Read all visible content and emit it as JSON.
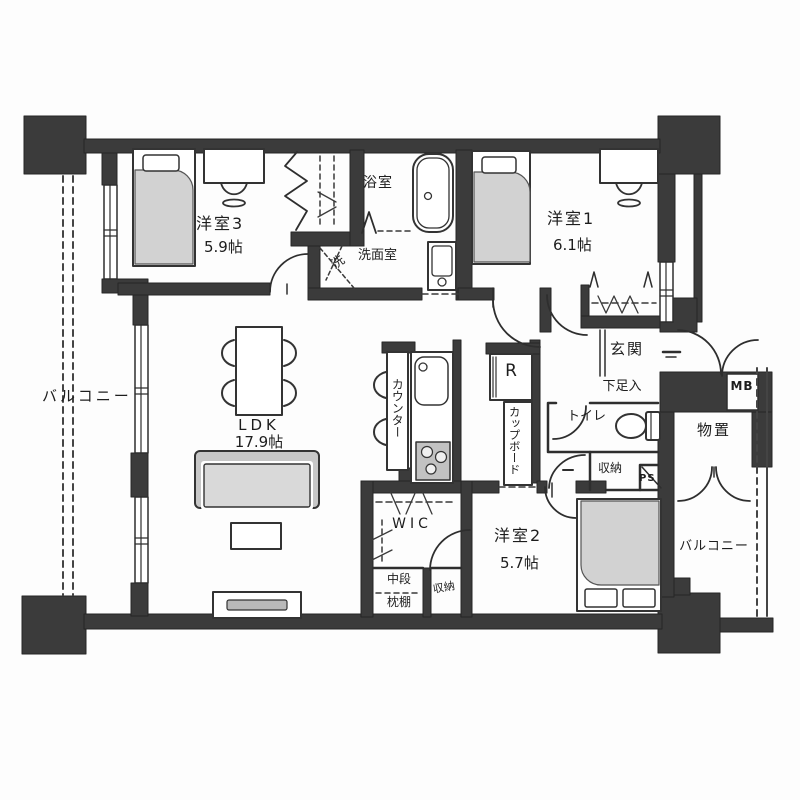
{
  "plan": {
    "type": "apartment-floorplan",
    "rooms": {
      "balcony_left": {
        "label": "バルコニー"
      },
      "bedroom3": {
        "label": "洋室3",
        "size": "5.9帖"
      },
      "bathroom": {
        "label": "浴室"
      },
      "washroom": {
        "label": "洗面室"
      },
      "washer_space": {
        "label": "洗"
      },
      "bedroom1": {
        "label": "洋室1",
        "size": "6.1帖"
      },
      "entrance": {
        "label": "玄関"
      },
      "shoe_cabinet": {
        "label": "下足入"
      },
      "meter_box": {
        "label": "MB"
      },
      "toilet": {
        "label": "トイレ"
      },
      "hall_storage": {
        "label": "収納"
      },
      "pipe_space": {
        "label": "PS"
      },
      "storage_room": {
        "label": "物置"
      },
      "balcony_right": {
        "label": "バルコニー"
      },
      "ldk": {
        "label": "LDK",
        "size": "17.9帖"
      },
      "counter": {
        "label": "カウンター"
      },
      "refrigerator": {
        "label": "R"
      },
      "cupboard": {
        "label": "カップボード"
      },
      "wic": {
        "label": "WIC"
      },
      "shelf_mid": {
        "label": "中段"
      },
      "shelf_pillow": {
        "label": "枕棚"
      },
      "wic_storage": {
        "label": "収納"
      },
      "bedroom2": {
        "label": "洋室2",
        "size": "5.7帖"
      }
    },
    "colors": {
      "wall": "#3b3b3b",
      "line": "#2e2e2e",
      "furniture": "#d2d2d2",
      "stove": "#c2c2c2",
      "background": "#fdfdfd"
    }
  }
}
